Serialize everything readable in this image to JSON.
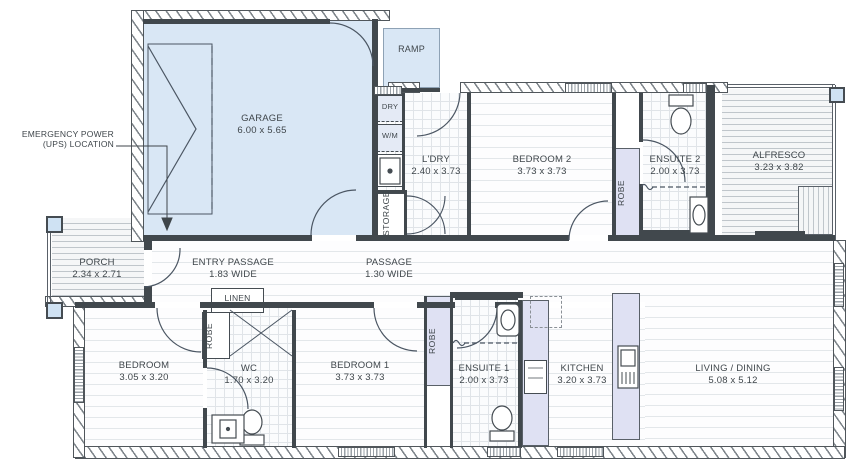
{
  "plan": {
    "annotations": {
      "emergency_line1": "EMERGENCY POWER",
      "emergency_line2": "(UPS) LOCATION"
    },
    "labels": {
      "robe": "ROBE",
      "storage": "STORAGE",
      "linen": "LINEN",
      "dry": "DRY",
      "wm": "W/M",
      "ramp": "RAMP"
    },
    "rooms": {
      "garage": {
        "name": "GARAGE",
        "dims": "6.00 x 5.65"
      },
      "ldry": {
        "name": "L'DRY",
        "dims": "2.40 x 3.73"
      },
      "bedroom2": {
        "name": "BEDROOM 2",
        "dims": "3.73 x 3.73"
      },
      "ensuite2": {
        "name": "ENSUITE 2",
        "dims": "2.00 x 3.73"
      },
      "alfresco": {
        "name": "ALFRESCO",
        "dims": "3.23 x 3.82"
      },
      "porch": {
        "name": "PORCH",
        "dims": "2.34 x 2.71"
      },
      "entry_passage": {
        "name": "ENTRY PASSAGE",
        "dims": "1.83 WIDE"
      },
      "passage": {
        "name": "PASSAGE",
        "dims": "1.30 WIDE"
      },
      "bedroom": {
        "name": "BEDROOM",
        "dims": "3.05 x 3.20"
      },
      "wc": {
        "name": "WC",
        "dims": "1.70 x 3.20"
      },
      "bedroom1": {
        "name": "BEDROOM 1",
        "dims": "3.73 x 3.73"
      },
      "ensuite1": {
        "name": "ENSUITE 1",
        "dims": "2.00 x 3.73"
      },
      "kitchen": {
        "name": "KITCHEN",
        "dims": "3.20 x 3.73"
      },
      "living": {
        "name": "LIVING / DINING",
        "dims": "5.08 x 5.12"
      }
    },
    "colors": {
      "garage_fill": "#d9e7f5",
      "joinery_fill": "#dfe1f3",
      "wall": "#41484d",
      "text": "#3f464b"
    }
  }
}
